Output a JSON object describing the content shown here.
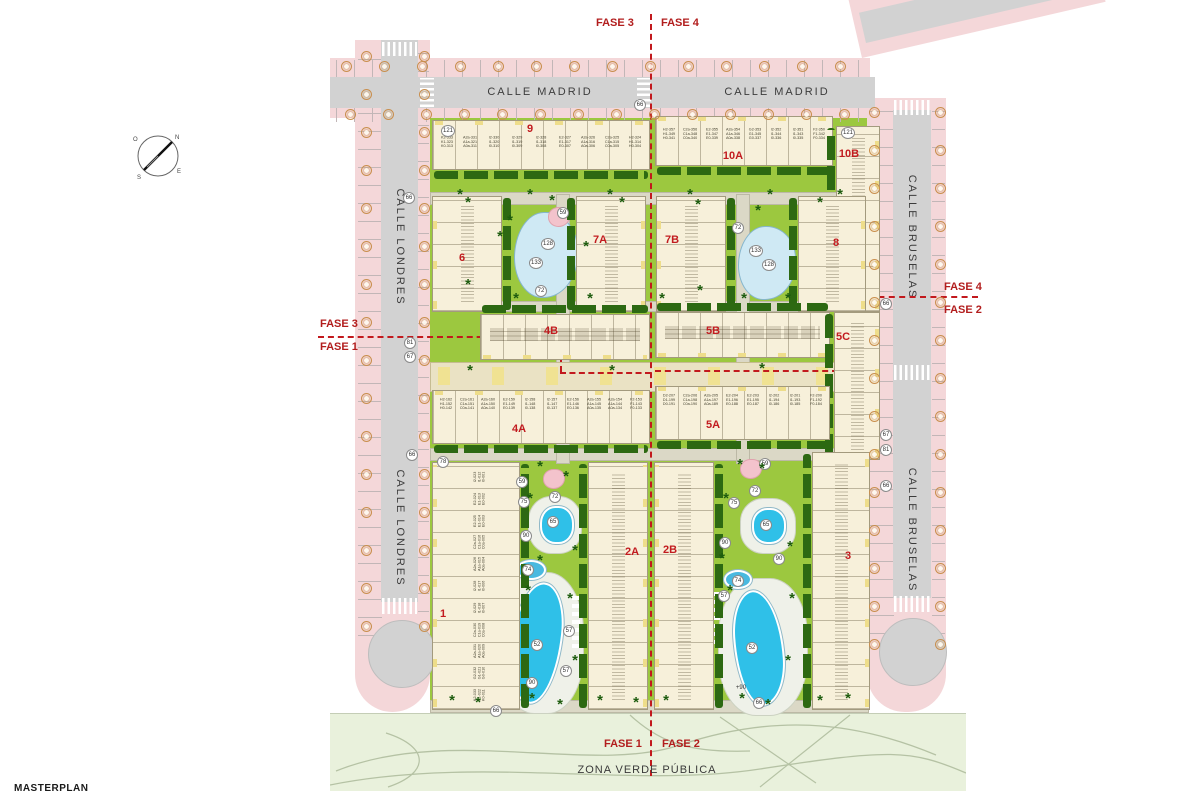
{
  "title": "MASTERPLAN",
  "legend": {
    "zona_verde": "ZONA VERDE PÚBLICA"
  },
  "compass": {
    "n": "N",
    "s": "S",
    "e": "E",
    "o": "O"
  },
  "streets": {
    "madrid_1": "CALLE MADRID",
    "madrid_2": "CALLE MADRID",
    "londres_1": "CALLE LONDRES",
    "londres_2": "CALLE LONDRES",
    "bruselas_1": "CALLE BRUSELAS",
    "bruselas_2": "CALLE BRUSELAS"
  },
  "phases": {
    "top_left": "FASE 3",
    "top_right": "FASE 4",
    "bottom_left": "FASE 1",
    "bottom_right": "FASE 2",
    "mid_left_upper": "FASE 3",
    "mid_left_lower": "FASE 1",
    "mid_right_upper": "FASE 4",
    "mid_right_lower": "FASE 2"
  },
  "colors": {
    "accent_red": "#c21b1f",
    "fase_red": "#b21d1d",
    "street_pink": "#f4d7d9",
    "road_gray": "#d2d2d2",
    "lawn_green": "#9cc83f",
    "public_green": "#e9f1dc",
    "building_cream": "#f7f0da",
    "hedge_green": "#2d6912",
    "pool_blue": "#2fc0e8",
    "pond_blue": "#cfe9f4",
    "path_tan": "#dbd8c6",
    "axis_beige": "#eae2c4"
  },
  "blocks": [
    {
      "id": "9",
      "x": 432,
      "y": 120,
      "w": 218,
      "h": 50,
      "orient": "h",
      "hedge": "bottom",
      "lx": 530,
      "ly": 129,
      "units": "units9",
      "utop": 16
    },
    {
      "id": "10A",
      "x": 655,
      "y": 116,
      "w": 178,
      "h": 50,
      "orient": "h",
      "hedge": "bottom",
      "lx": 733,
      "ly": 156,
      "units": "units10A",
      "utop": 12
    },
    {
      "id": "10B",
      "x": 836,
      "y": 126,
      "w": 44,
      "h": 186,
      "orient": "v",
      "hedge": "left",
      "lx": 849,
      "ly": 154,
      "smudge": true
    },
    {
      "id": "6",
      "x": 432,
      "y": 196,
      "w": 70,
      "h": 116,
      "orient": "v",
      "hedge": "right",
      "lx": 462,
      "ly": 258,
      "smudge": true
    },
    {
      "id": "7A",
      "x": 576,
      "y": 196,
      "w": 70,
      "h": 116,
      "orient": "v",
      "hedge": "left",
      "lx": 600,
      "ly": 240,
      "smudge": true
    },
    {
      "id": "7B",
      "x": 656,
      "y": 196,
      "w": 70,
      "h": 116,
      "orient": "v",
      "hedge": "right",
      "lx": 672,
      "ly": 240,
      "smudge": true
    },
    {
      "id": "8",
      "x": 798,
      "y": 196,
      "w": 68,
      "h": 116,
      "orient": "v",
      "hedge": "left",
      "lx": 836,
      "ly": 243,
      "smudge": true
    },
    {
      "id": "4B",
      "x": 480,
      "y": 314,
      "w": 170,
      "h": 46,
      "orient": "h",
      "hedge": "top",
      "lx": 551,
      "ly": 331,
      "smudge": true
    },
    {
      "id": "5B",
      "x": 655,
      "y": 312,
      "w": 175,
      "h": 46,
      "orient": "h",
      "hedge": "top",
      "lx": 713,
      "ly": 331,
      "smudge": true
    },
    {
      "id": "5C",
      "x": 834,
      "y": 312,
      "w": 46,
      "h": 148,
      "orient": "v",
      "hedge": "left",
      "lx": 843,
      "ly": 337,
      "smudge": true
    },
    {
      "id": "4A",
      "x": 432,
      "y": 390,
      "w": 218,
      "h": 54,
      "orient": "h",
      "hedge": "bottom",
      "lx": 519,
      "ly": 429,
      "units": "units4A",
      "utop": 8
    },
    {
      "id": "5A",
      "x": 655,
      "y": 386,
      "w": 175,
      "h": 54,
      "orient": "h",
      "hedge": "bottom",
      "lx": 713,
      "ly": 425,
      "units": "units5A",
      "utop": 8
    },
    {
      "id": "1",
      "x": 432,
      "y": 462,
      "w": 88,
      "h": 248,
      "orient": "v",
      "hedge": "right",
      "lx": 443,
      "ly": 614,
      "unitsV": "units1"
    },
    {
      "id": "2A",
      "x": 588,
      "y": 462,
      "w": 60,
      "h": 248,
      "orient": "v",
      "hedge": "left",
      "lx": 632,
      "ly": 552,
      "smudge": true
    },
    {
      "id": "2B",
      "x": 654,
      "y": 462,
      "w": 60,
      "h": 248,
      "orient": "v",
      "hedge": "right",
      "lx": 670,
      "ly": 550,
      "smudge": true
    },
    {
      "id": "3",
      "x": 812,
      "y": 452,
      "w": 58,
      "h": 258,
      "orient": "v",
      "hedge": "left",
      "lx": 848,
      "ly": 556,
      "smudge": true
    }
  ],
  "units": {
    "units9": [
      [
        "K2-333",
        "K1-323",
        "K0-313"
      ],
      [
        "A2a-331",
        "A1a-321",
        "A0a-311"
      ],
      [
        "I2-330",
        "I1-320",
        "I0-310"
      ],
      [
        "I2-329",
        "I1-319",
        "I0-309"
      ],
      [
        "I2-328",
        "I1-318",
        "I0-308"
      ],
      [
        "E2-327",
        "E1-317",
        "E0-307"
      ],
      [
        "A2a-326",
        "A1a-316",
        "A0a-306"
      ],
      [
        "C2a-325",
        "C1a-315",
        "C0a-305"
      ],
      [
        "H2-324",
        "H1-314",
        "H0-304"
      ]
    ],
    "units10A": [
      [
        "H2-357",
        "H1-349",
        "H0-341"
      ],
      [
        "C2a-356",
        "C1a-348",
        "C0a-340"
      ],
      [
        "E2-355",
        "E1-347",
        "E0-339"
      ],
      [
        "A2a-354",
        "A1a-346",
        "A0a-338"
      ],
      [
        "G2-353",
        "G1-345",
        "G0-337"
      ],
      [
        "I2-352",
        "I1-344",
        "I0-336"
      ],
      [
        "I2-351",
        "I1-343",
        "I0-335"
      ],
      [
        "F2-350",
        "F1-342",
        "F0-334"
      ]
    ],
    "units4A": [
      [
        "H2-162",
        "H1-152",
        "H0-142"
      ],
      [
        "C2a-161",
        "C1a-151",
        "C0a-141"
      ],
      [
        "A2a-160",
        "A1a-150",
        "A0a-140"
      ],
      [
        "E2-159",
        "E1-149",
        "E0-139"
      ],
      [
        "I2-158",
        "I1-148",
        "I0-138"
      ],
      [
        "I2-157",
        "I1-147",
        "I0-137"
      ],
      [
        "E2-156",
        "E1-146",
        "E0-136"
      ],
      [
        "A2a-155",
        "A1a-145",
        "A0a-135"
      ],
      [
        "A2a-154",
        "A1a-144",
        "A0a-134"
      ],
      [
        "F2-153",
        "F1-143",
        "F0-133"
      ]
    ],
    "units5A": [
      [
        "D2-207",
        "D1-199",
        "D0-191"
      ],
      [
        "C2a-206",
        "C1a-198",
        "C0a-190"
      ],
      [
        "A2a-205",
        "A1a-197",
        "A0a-189"
      ],
      [
        "E2-204",
        "E1-196",
        "E0-188"
      ],
      [
        "E2-203",
        "E1-195",
        "E0-187"
      ],
      [
        "I2-202",
        "I1-194",
        "I0-186"
      ],
      [
        "I2-201",
        "I1-193",
        "I0-185"
      ],
      [
        "F2-200",
        "F1-192",
        "F0-184"
      ]
    ],
    "units1": [
      [
        "I2-023",
        "I1-012",
        "I0-001"
      ],
      [
        "E2-024",
        "E1-013",
        "E0-002"
      ],
      [
        "E2-025",
        "E1-014",
        "E0-003"
      ],
      [
        "C2a-027",
        "C1a-016",
        "C0a-005"
      ],
      [
        "A2a-026",
        "A1a-015",
        "A0a-004"
      ],
      [
        "I2-028",
        "I1-017",
        "I0-006"
      ],
      [
        "I2-029",
        "I1-018",
        "I0-007"
      ],
      [
        "C2a-030",
        "C1a-019",
        "C0a-008"
      ],
      [
        "A2a-031",
        "A1a-020",
        "A0a-009"
      ],
      [
        "G2-032",
        "G1-021",
        "G0-010"
      ],
      [
        "K2-033",
        "K1-022",
        "K0-011"
      ]
    ]
  },
  "markers": [
    {
      "x": 448,
      "y": 131,
      "v": "121"
    },
    {
      "x": 848,
      "y": 133,
      "v": "121"
    },
    {
      "x": 640,
      "y": 105,
      "v": "66"
    },
    {
      "x": 409,
      "y": 198,
      "v": "66"
    },
    {
      "x": 410,
      "y": 343,
      "v": "81"
    },
    {
      "x": 410,
      "y": 357,
      "v": "67"
    },
    {
      "x": 412,
      "y": 455,
      "v": "66"
    },
    {
      "x": 443,
      "y": 462,
      "v": "78"
    },
    {
      "x": 886,
      "y": 304,
      "v": "66"
    },
    {
      "x": 886,
      "y": 435,
      "v": "67"
    },
    {
      "x": 886,
      "y": 450,
      "v": "81"
    },
    {
      "x": 886,
      "y": 486,
      "v": "66"
    },
    {
      "x": 563,
      "y": 213,
      "v": "59"
    },
    {
      "x": 548,
      "y": 244,
      "v": "128"
    },
    {
      "x": 536,
      "y": 263,
      "v": "133"
    },
    {
      "x": 541,
      "y": 291,
      "v": "72"
    },
    {
      "x": 738,
      "y": 228,
      "v": "72"
    },
    {
      "x": 756,
      "y": 251,
      "v": "133"
    },
    {
      "x": 769,
      "y": 265,
      "v": "128"
    },
    {
      "x": 522,
      "y": 482,
      "v": "59"
    },
    {
      "x": 524,
      "y": 502,
      "v": "75"
    },
    {
      "x": 555,
      "y": 497,
      "v": "72"
    },
    {
      "x": 526,
      "y": 536,
      "v": "90"
    },
    {
      "x": 553,
      "y": 522,
      "v": "65"
    },
    {
      "x": 765,
      "y": 464,
      "v": "59"
    },
    {
      "x": 734,
      "y": 503,
      "v": "75"
    },
    {
      "x": 755,
      "y": 491,
      "v": "72"
    },
    {
      "x": 725,
      "y": 543,
      "v": "90"
    },
    {
      "x": 766,
      "y": 525,
      "v": "65"
    },
    {
      "x": 779,
      "y": 559,
      "v": "90"
    },
    {
      "x": 528,
      "y": 570,
      "v": "74"
    },
    {
      "x": 738,
      "y": 581,
      "v": "74"
    },
    {
      "x": 537,
      "y": 645,
      "v": "52"
    },
    {
      "x": 752,
      "y": 648,
      "v": "52"
    },
    {
      "x": 569,
      "y": 631,
      "v": "57"
    },
    {
      "x": 566,
      "y": 671,
      "v": "57"
    },
    {
      "x": 532,
      "y": 683,
      "v": "90"
    },
    {
      "x": 724,
      "y": 596,
      "v": "57"
    },
    {
      "x": 496,
      "y": 711,
      "v": "66"
    },
    {
      "x": 759,
      "y": 703,
      "v": "66"
    }
  ],
  "plain_texts": [
    {
      "x": 741,
      "y": 688,
      "v": "+90"
    }
  ]
}
